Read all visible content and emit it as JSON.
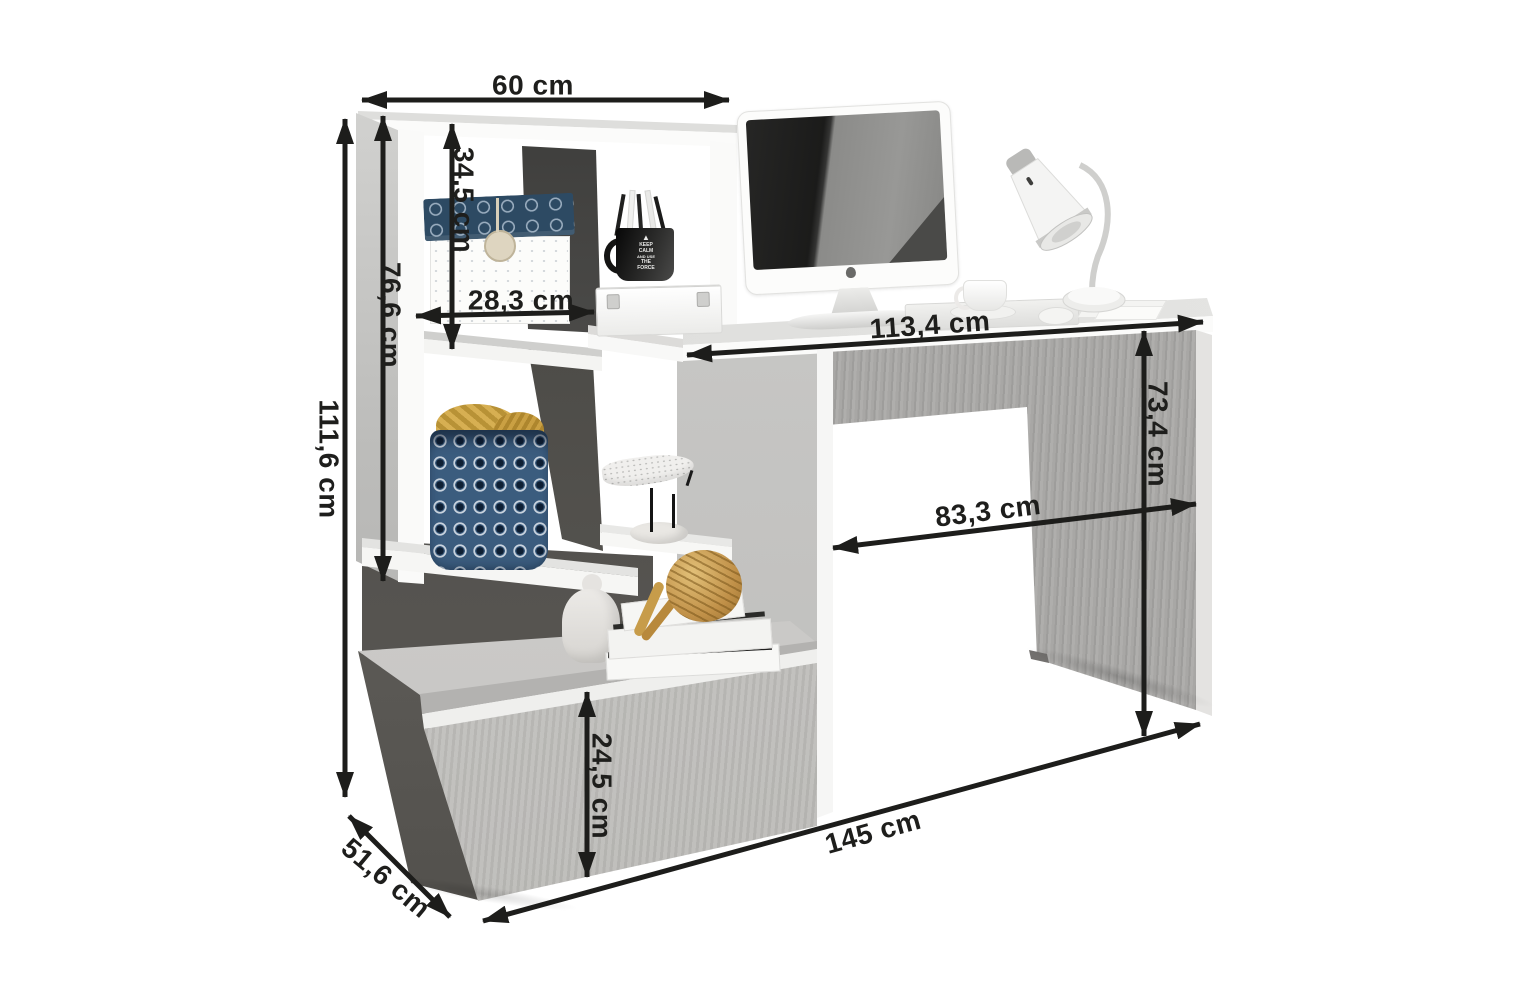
{
  "dims": {
    "d60": "60 cm",
    "d345": "34,5 cm",
    "d766": "76,6 cm",
    "d1116": "111,6 cm",
    "d283": "28,3 cm",
    "d1134": "113,4 cm",
    "d734": "73,4 cm",
    "d833": "83,3 cm",
    "d245": "24,5 cm",
    "d145": "145 cm",
    "d516": "51,6 cm"
  },
  "mug": {
    "icon": "▲",
    "lines": [
      "KEEP",
      "CALM",
      "AND USE",
      "THE",
      "FORCE"
    ]
  },
  "colors": {
    "arrow": "#1d1d1b",
    "concrete": "#a8a7a5",
    "concrete_dark": "#55534f",
    "white_panel": "#fafaf9",
    "basket_navy": "#3b5c7e",
    "blanket_mustard": "#d2a63e",
    "rope_tan": "#c59a4d"
  }
}
